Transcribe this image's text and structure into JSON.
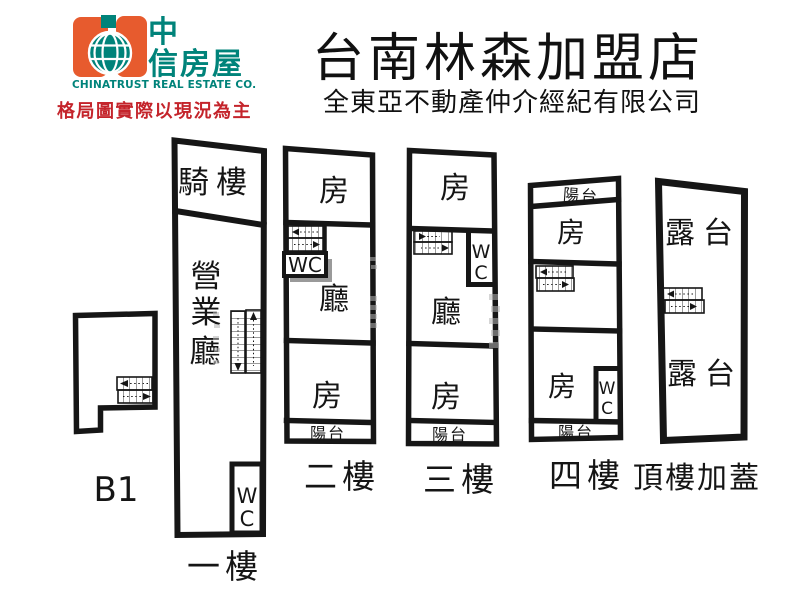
{
  "header": {
    "brand": {
      "cn_top": "中",
      "cn_bottom": "信房屋",
      "en": "CHINATRUST REAL ESTATE CO."
    },
    "disclaimer": "格局圖實際以現況為主",
    "store_title": "台南林森加盟店",
    "company": "全東亞不動產仲介經紀有限公司"
  },
  "colors": {
    "brand_orange": "#E75B2E",
    "brand_teal": "#00837A",
    "disclaimer_red": "#C4242B",
    "plan_line": "#161616",
    "wc_shadow_grey": "#9A9A9A"
  },
  "plans": {
    "b1": {
      "name": "B1"
    },
    "f1": {
      "name": "一樓",
      "arcade": "騎樓",
      "hall": "營業廳",
      "wc": "WC"
    },
    "f2": {
      "name": "二樓",
      "room_top": "房",
      "wc": "WC",
      "living": "廳",
      "room_bottom": "房",
      "balcony": "陽台"
    },
    "f3": {
      "name": "三樓",
      "room_top": "房",
      "wc": "WC",
      "living": "廳",
      "room_bottom": "房",
      "balcony": "陽台"
    },
    "f4": {
      "name": "四樓",
      "balcony_top": "陽台",
      "room_top": "房",
      "room_bottom": "房",
      "wc": "WC",
      "balcony_bottom": "陽台"
    },
    "roof": {
      "name": "頂樓加蓋",
      "terrace_top": "露台",
      "terrace_bottom": "露台"
    }
  }
}
